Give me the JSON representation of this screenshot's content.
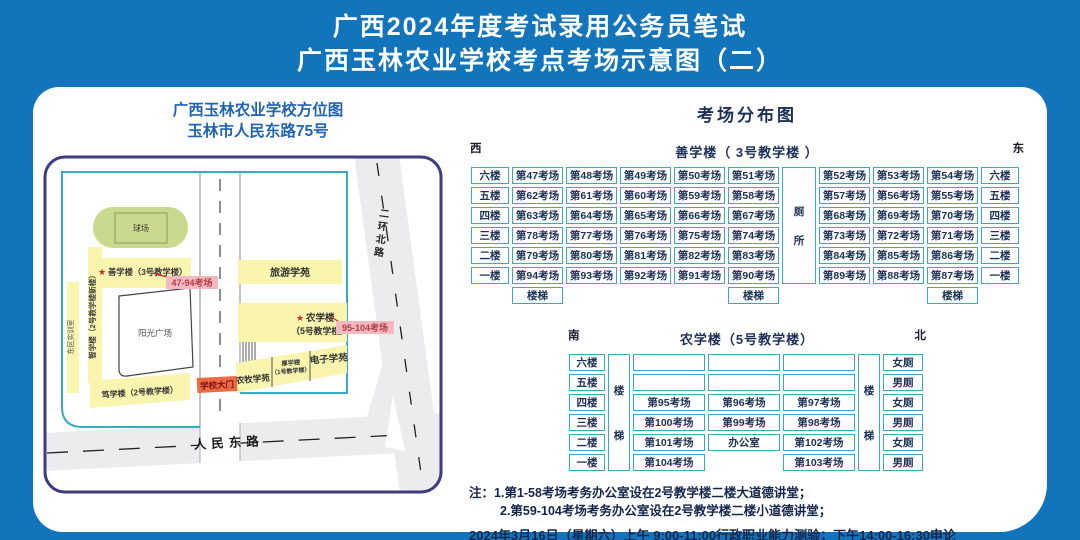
{
  "colors": {
    "background": "#1274ba",
    "accent_teal": "#36abc6",
    "building_yellow": "#f9f4ae",
    "field_green": "#c9da8e",
    "label_pink": "#f3b9c1",
    "gate_orange": "#ec6a44",
    "text_navy": "#1c3156",
    "road_gray": "#ececee",
    "map_title_blue": "#1f63b5",
    "accent_red": "#cc2a2a"
  },
  "header": {
    "title_line1": "广西2024年度考试录用公务员笔试",
    "title_line2": "广西玉林农业学校考点考场示意图（二）"
  },
  "map": {
    "title_line1": "广西玉林农业学校方位图",
    "title_line2": "玉林市人民东路75号",
    "labels": {
      "star": "★",
      "field": "球场",
      "building_3": "善学楼（3号教学楼）",
      "building_2_new": "智学楼（2号教学楼新楼）",
      "east_training": "东区实训室",
      "plaza": "阳光广场",
      "building_2": "笃学楼（2号教学楼）",
      "tourism": "旅游学苑",
      "building_5_line1": "农学楼",
      "building_5_line2": "（5号教学楼）",
      "rooms_47_94": "47-94考场",
      "rooms_95_104": "95-104考场",
      "gate": "学校大门",
      "animal_husbandry": "农牧学苑",
      "building_1_line1": "厚学楼",
      "building_1_line2": "（1号教学楼）",
      "electronics": "电子学苑",
      "road_south": "人民东路",
      "road_east": "二环北路"
    }
  },
  "distribution": {
    "title": "考场分布图",
    "building3": {
      "title": "善学楼（ 3号教学楼 ）",
      "west": "西",
      "east": "东",
      "wc": "厕所",
      "stairs": "楼梯",
      "rows": [
        {
          "floor": "六楼",
          "left": [
            "第47考场",
            "第48考场",
            "第49考场",
            "第50考场",
            "第51考场"
          ],
          "right": [
            "第52考场",
            "第53考场",
            "第54考场"
          ]
        },
        {
          "floor": "五楼",
          "left": [
            "第62考场",
            "第61考场",
            "第60考场",
            "第59考场",
            "第58考场"
          ],
          "right": [
            "第57考场",
            "第56考场",
            "第55考场"
          ]
        },
        {
          "floor": "四楼",
          "left": [
            "第63考场",
            "第64考场",
            "第65考场",
            "第66考场",
            "第67考场"
          ],
          "right": [
            "第68考场",
            "第69考场",
            "第70考场"
          ]
        },
        {
          "floor": "三楼",
          "left": [
            "第78考场",
            "第77考场",
            "第76考场",
            "第75考场",
            "第74考场"
          ],
          "right": [
            "第73考场",
            "第72考场",
            "第71考场"
          ]
        },
        {
          "floor": "二楼",
          "left": [
            "第79考场",
            "第80考场",
            "第81考场",
            "第82考场",
            "第83考场"
          ],
          "right": [
            "第84考场",
            "第85考场",
            "第86考场"
          ]
        },
        {
          "floor": "一楼",
          "left": [
            "第94考场",
            "第93考场",
            "第92考场",
            "第91考场",
            "第90考场"
          ],
          "right": [
            "第89考场",
            "第88考场",
            "第87考场"
          ]
        }
      ]
    },
    "building5": {
      "title": "农学楼（5号教学楼）",
      "south": "南",
      "north": "北",
      "stairs": "楼梯",
      "rows": [
        {
          "floor": "六楼",
          "cells": [
            "",
            "",
            ""
          ],
          "wc": "女厕"
        },
        {
          "floor": "五楼",
          "cells": [
            "",
            "",
            ""
          ],
          "wc": "男厕"
        },
        {
          "floor": "四楼",
          "cells": [
            "第95考场",
            "第96考场",
            "第97考场"
          ],
          "wc": "女厕"
        },
        {
          "floor": "三楼",
          "cells": [
            "第100考场",
            "第99考场",
            "第98考场"
          ],
          "wc": "男厕"
        },
        {
          "floor": "二楼",
          "cells": [
            "第101考场",
            "办公室",
            "第102考场"
          ],
          "wc": "女厕"
        },
        {
          "floor": "一楼",
          "cells": [
            "第104考场",
            null,
            "第103考场"
          ],
          "wc": "男厕"
        }
      ]
    }
  },
  "notes": {
    "prefix": "注：",
    "line1": "1.第1-58考场考务办公室设在2号教学楼二楼大道德讲堂；",
    "line2": "2.第59-104考场考务办公室设在2号教学楼二楼小道德讲堂；",
    "schedule": "2024年3月16日（星期六）上午 9:00-11:00行政职业能力测验；下午14:00-16:30申论",
    "hotline": "考试违纪举报电话: 2806803(市委组织部公务员一科)　　2680828(市人事考试院)"
  }
}
